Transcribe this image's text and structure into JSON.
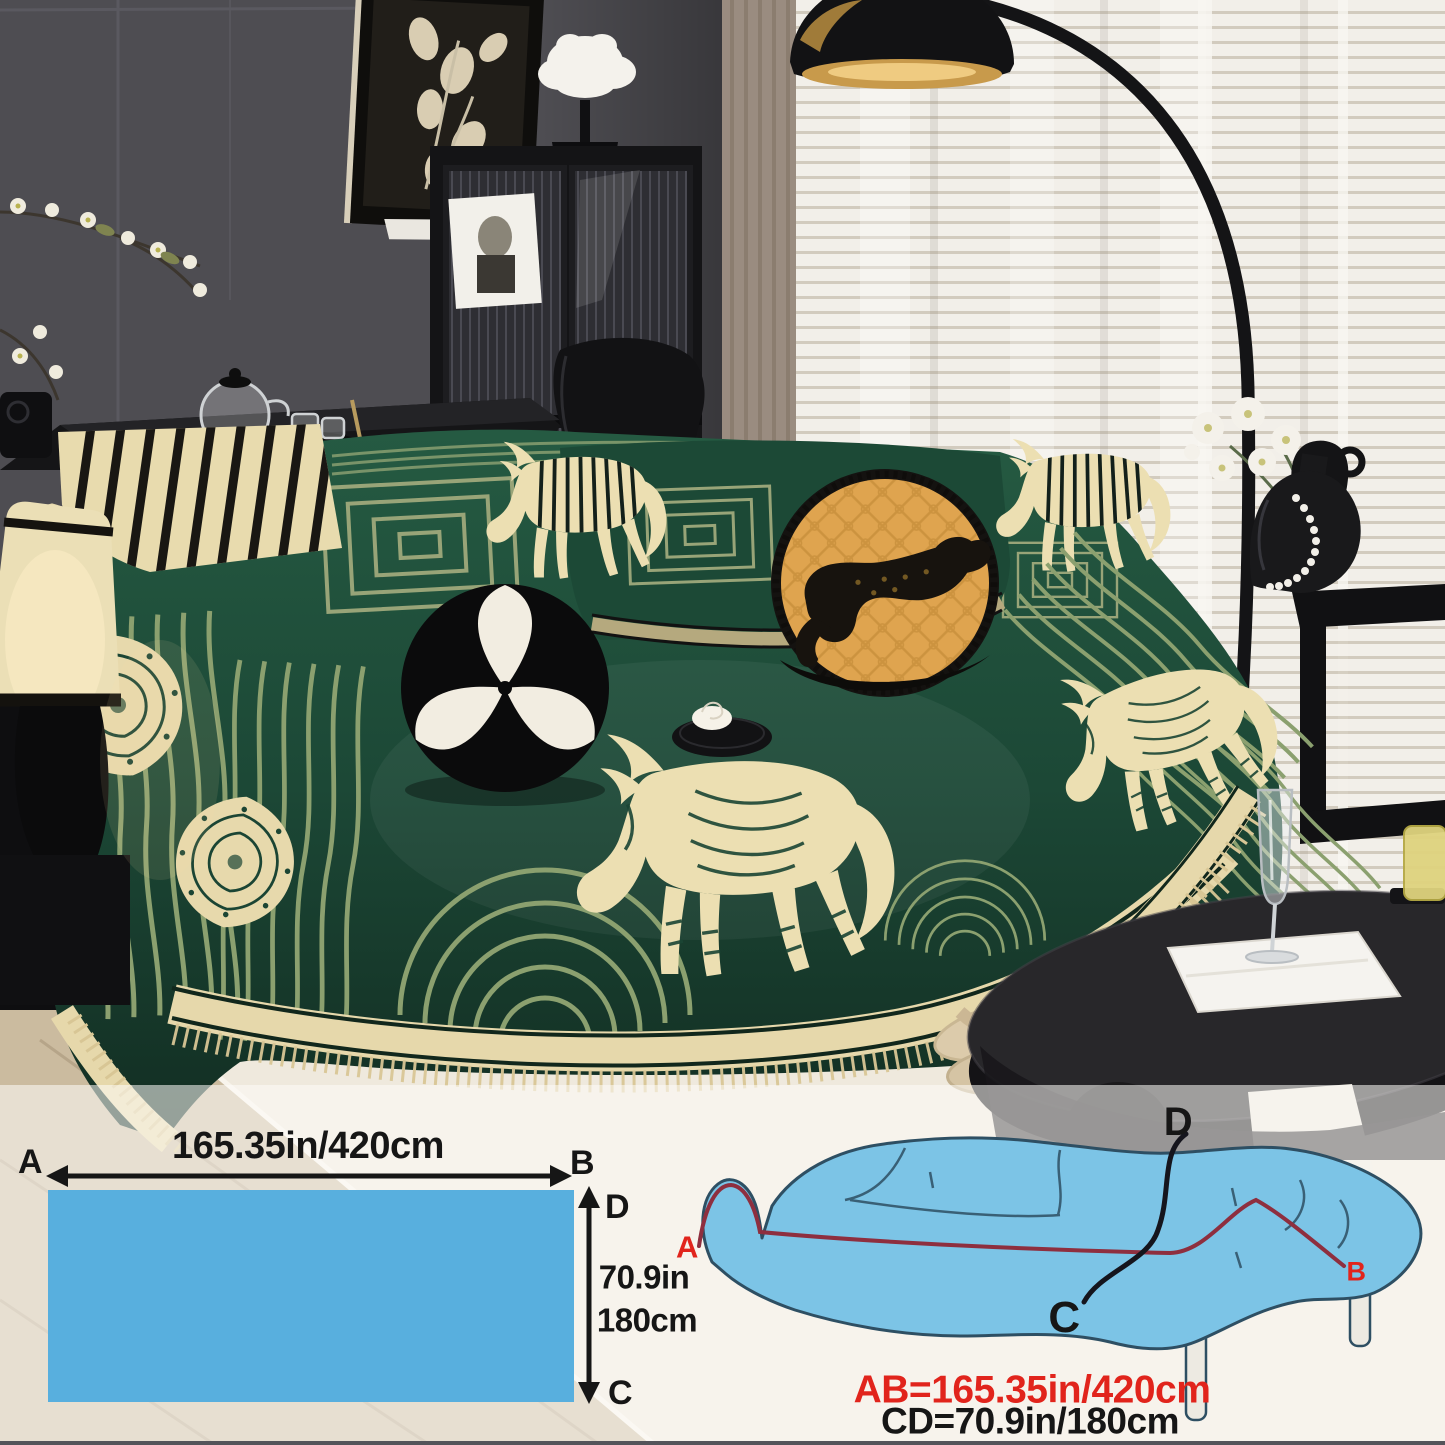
{
  "page": {
    "description": "Product photo of a dark green chenille horse-pattern sofa cover blanket draped over a couch in a living room, with a fabric size diagram strip at the bottom"
  },
  "photo": {
    "palette": {
      "wall": "#4E4D52",
      "blinds": "#F1EEE8",
      "curtain": "#9A8C80",
      "sofa_green": "#1D4A36",
      "sofa_green_dark": "#132F24",
      "pattern_cream": "#ECDFB2",
      "stripe_sage": "#8BA06F",
      "pillow_orange": "#DFA44F",
      "leopard_black": "#17130E",
      "rug": "#EFE9DD",
      "wood_floor": "#CBBB9F",
      "table_black": "#28272A"
    }
  },
  "size_chart": {
    "overlay_color": "rgba(253,252,248,0.56)",
    "flat": {
      "corner_a": "A",
      "corner_b": "B",
      "corner_c": "C",
      "corner_d": "D",
      "width_label": "165.35in/420cm",
      "height_label_inches": "70.9in",
      "height_label_cm": "180cm",
      "swatch_color": "#58AFDE",
      "line_color": "#161616"
    },
    "sofa": {
      "corner_a": "A",
      "corner_b": "B",
      "corner_c": "C",
      "corner_d": "D",
      "ab_measure": "AB=165.35in/420cm",
      "cd_measure": "CD=70.9in/180cm",
      "body_color": "#7CC4E6",
      "outline_color": "#2E4F63",
      "ab_line_color": "#8E2F3F",
      "label_red": "#E1241C",
      "label_black": "#161616"
    }
  }
}
